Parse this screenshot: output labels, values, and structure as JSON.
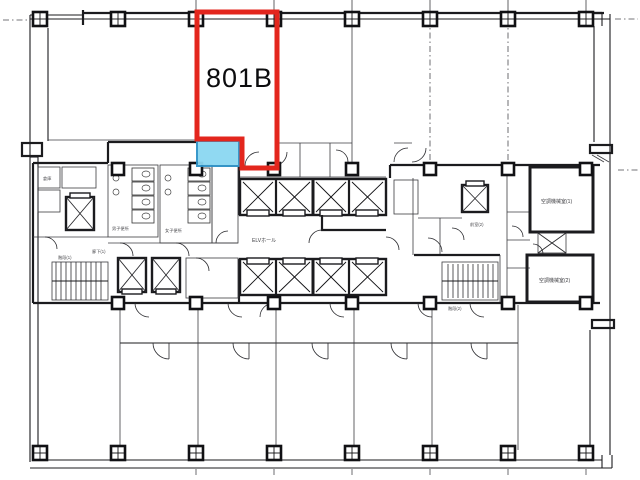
{
  "page": {
    "background": "#ffffff",
    "description": "office building floor plate plan"
  },
  "unit": {
    "id": "801B"
  },
  "colors": {
    "outline_red": "#e3261d",
    "highlight_fill": "#8bd7f2",
    "highlight_border": "#2f93c8",
    "plan_line": "#1b1b1e"
  },
  "labels": {
    "elevator_hall": "ELVホール",
    "hvac_room_1": "空調機械室(1)",
    "hvac_room_2": "空調機械室(2)",
    "toilet_men": "男子便所",
    "toilet_women": "女子便所",
    "corridor": "廊下(1)",
    "anteroom": "前室(2)",
    "stair_left": "階段(1)",
    "stair_right": "階段(2)",
    "storage": "倉庫"
  }
}
